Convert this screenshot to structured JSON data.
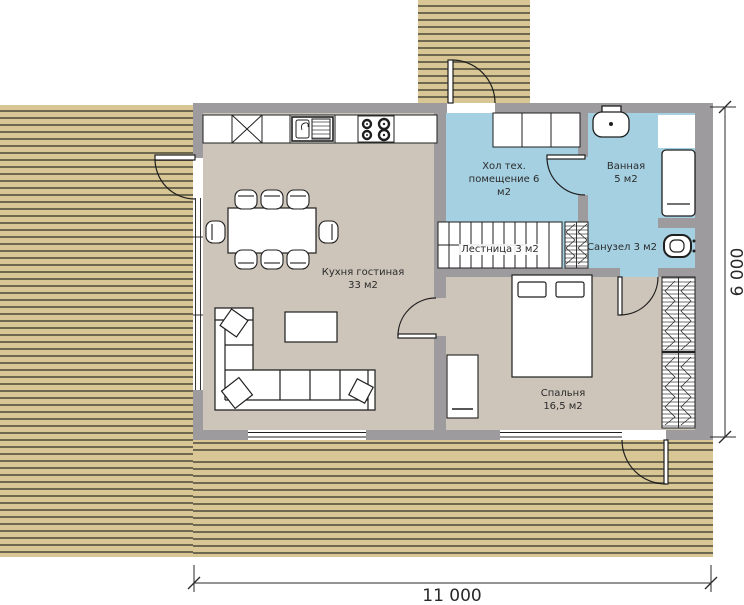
{
  "plan_title": "Floor plan",
  "rooms": {
    "kitchen_living": {
      "name": "Кухня гостиная",
      "area": "33 м2"
    },
    "hall": {
      "line1": "Хол тех.",
      "line2": "помещение 6",
      "line3": "м2"
    },
    "bathroom": {
      "name": "Ванная",
      "area": "5 м2"
    },
    "stairs": {
      "label": "Лестница 3 м2"
    },
    "wc": {
      "label": "Санузел 3 м2"
    },
    "bedroom": {
      "name": "Спальня",
      "area": "16,5 м2"
    }
  },
  "dimensions": {
    "width_label": "11 000",
    "height_label": "6 000"
  },
  "fixtures": {
    "stove": "stove-icon",
    "kitchen_sink": "kitchen-sink-icon",
    "bathtub": "bathtub-icon",
    "washbasin": "washbasin-icon",
    "toilet": "toilet-icon",
    "bed": "double-bed",
    "sofa": "corner-sofa",
    "dining_table": "dining-table",
    "staircase": "staircase"
  },
  "colors": {
    "deck": "#d8c794",
    "deck_stripe": "#6f6850",
    "wall": "#9e9b9e",
    "floor": "#cdc4ba",
    "wet": "#a5d0e2",
    "line": "#1f1f1f",
    "dim": "#2a2a2a",
    "paper": "#ffffff"
  }
}
